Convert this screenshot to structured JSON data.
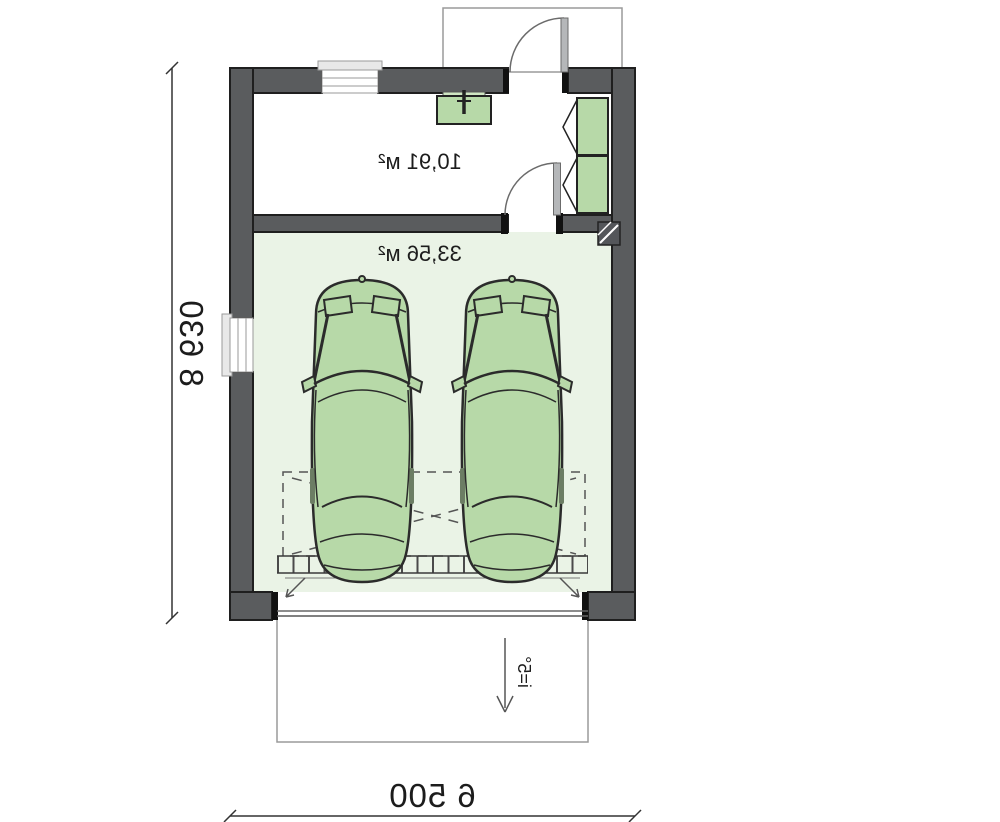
{
  "plan": {
    "type": "garage-floor-plan-mirrored",
    "labels": {
      "room_area": "10,91 м²",
      "garage_area": "33,56 м²",
      "height_dim": "8 630",
      "width_dim": "6 500",
      "slope": "i=5°"
    },
    "colors": {
      "wall": "#5a5c5e",
      "wall_outline": "#1f1f1f",
      "garage_floor": "#eaf3e6",
      "furniture_green": "#b7d9a8",
      "door_leaf": "#b5b7b9",
      "line": "#2b2b2b"
    },
    "icons": [
      "car-top-view-icon",
      "wardrobe-icon",
      "boiler-icon",
      "flue-hatch-icon",
      "door-swing-icon",
      "window-icon",
      "slope-arrow-icon",
      "dimension-tick-icon"
    ]
  }
}
